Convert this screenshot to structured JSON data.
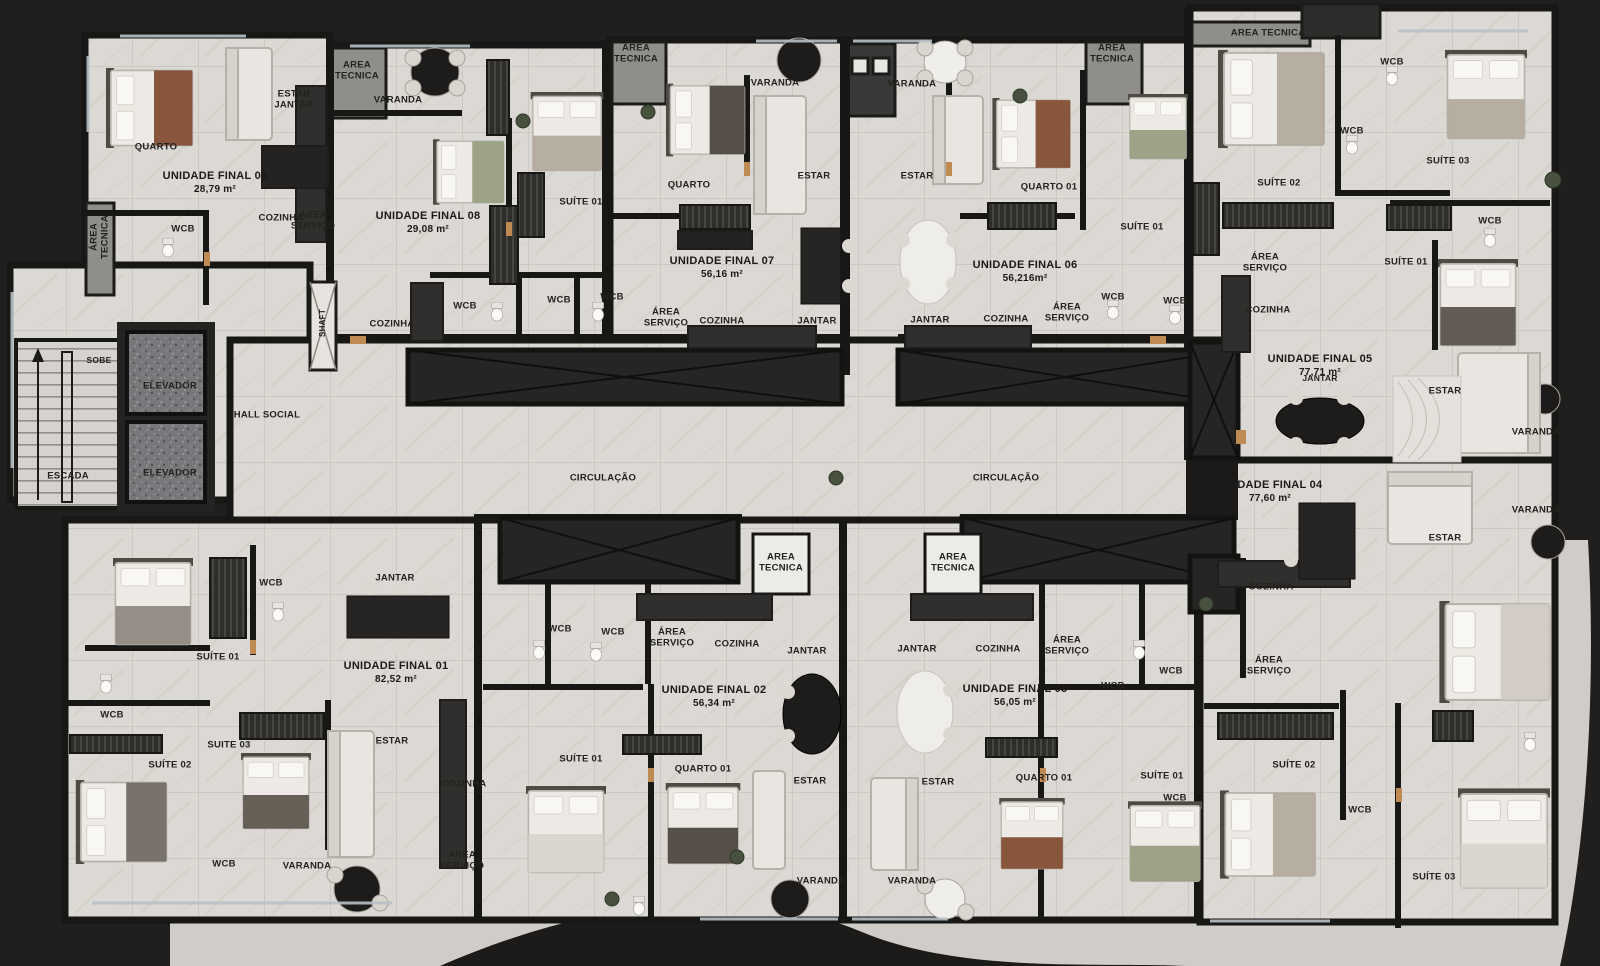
{
  "palette": {
    "background": "#201f1e",
    "floor": "#dcd9d4",
    "wall": "#171716",
    "tech_gray": "#8f8e8a",
    "white_box": "#edebe8",
    "wood_accent": "#c08b52",
    "label_color": "#23221f"
  },
  "units": [
    {
      "name": "UNIDADE FINAL 09",
      "area": "28,79 m²",
      "x": 215,
      "y": 183
    },
    {
      "name": "UNIDADE FINAL 08",
      "area": "29,08 m²",
      "x": 428,
      "y": 223
    },
    {
      "name": "UNIDADE FINAL 07",
      "area": "56,16 m²",
      "x": 722,
      "y": 268
    },
    {
      "name": "UNIDADE FINAL 06",
      "area": "56,216m²",
      "x": 1025,
      "y": 272
    },
    {
      "name": "UNIDADE FINAL 05",
      "area": "77,71 m²",
      "x": 1320,
      "y": 366
    },
    {
      "name": "UNIDADE FINAL 04",
      "area": "77,60 m²",
      "x": 1270,
      "y": 492
    },
    {
      "name": "UNIDADE FINAL 01",
      "area": "82,52 m²",
      "x": 396,
      "y": 673
    },
    {
      "name": "UNIDADE FINAL 02",
      "area": "56,34 m²",
      "x": 714,
      "y": 697
    },
    {
      "name": "UNIDADE FINAL 03",
      "area": "56,05 m²",
      "x": 1015,
      "y": 696
    }
  ],
  "rooms": [
    {
      "t": "QUARTO",
      "x": 156,
      "y": 147
    },
    {
      "t": "ESTAR\nJANTAR",
      "x": 294,
      "y": 100
    },
    {
      "t": "AREA\nTECNICA",
      "x": 357,
      "y": 71
    },
    {
      "t": "COZINHA",
      "x": 281,
      "y": 218
    },
    {
      "t": "ÁREA\nSERVIÇO",
      "x": 313,
      "y": 221
    },
    {
      "t": "WCB",
      "x": 183,
      "y": 229
    },
    {
      "t": "ÁREA\nTECNICA",
      "x": 100,
      "y": 237,
      "r": -90
    },
    {
      "t": "VARANDA",
      "x": 398,
      "y": 100
    },
    {
      "t": "SUÍTE 01",
      "x": 581,
      "y": 202
    },
    {
      "t": "WCB",
      "x": 465,
      "y": 306
    },
    {
      "t": "WCB",
      "x": 559,
      "y": 300
    },
    {
      "t": "COZINHA",
      "x": 392,
      "y": 324
    },
    {
      "t": "AREA\nTECNICA",
      "x": 636,
      "y": 54
    },
    {
      "t": "VARANDA",
      "x": 775,
      "y": 83
    },
    {
      "t": "QUARTO",
      "x": 689,
      "y": 185
    },
    {
      "t": "ESTAR",
      "x": 814,
      "y": 176
    },
    {
      "t": "WCB",
      "x": 612,
      "y": 297
    },
    {
      "t": "ÁREA\nSERVIÇO",
      "x": 666,
      "y": 318
    },
    {
      "t": "COZINHA",
      "x": 722,
      "y": 321
    },
    {
      "t": "JANTAR",
      "x": 817,
      "y": 321
    },
    {
      "t": "VARANDA",
      "x": 912,
      "y": 84
    },
    {
      "t": "AREA\nTECNICA",
      "x": 1112,
      "y": 54
    },
    {
      "t": "ESTAR",
      "x": 917,
      "y": 176
    },
    {
      "t": "QUARTO 01",
      "x": 1049,
      "y": 187
    },
    {
      "t": "SUÍTE 01",
      "x": 1142,
      "y": 227
    },
    {
      "t": "JANTAR",
      "x": 930,
      "y": 320
    },
    {
      "t": "COZINHA",
      "x": 1006,
      "y": 319
    },
    {
      "t": "ÁREA\nSERVIÇO",
      "x": 1067,
      "y": 313
    },
    {
      "t": "WCB",
      "x": 1113,
      "y": 297
    },
    {
      "t": "WCB",
      "x": 1175,
      "y": 301
    },
    {
      "t": "AREA TECNICA",
      "x": 1268,
      "y": 33
    },
    {
      "t": "WCB",
      "x": 1392,
      "y": 62
    },
    {
      "t": "WCB",
      "x": 1352,
      "y": 131
    },
    {
      "t": "SUÍTE 03",
      "x": 1448,
      "y": 161
    },
    {
      "t": "SUÍTE 02",
      "x": 1279,
      "y": 183
    },
    {
      "t": "WCB",
      "x": 1490,
      "y": 221
    },
    {
      "t": "SUÍTE 01",
      "x": 1406,
      "y": 262
    },
    {
      "t": "ÁREA\nSERVIÇO",
      "x": 1265,
      "y": 263
    },
    {
      "t": "COZINHA",
      "x": 1268,
      "y": 310
    },
    {
      "t": "JANTAR",
      "x": 1320,
      "y": 378,
      "s": 8.5
    },
    {
      "t": "ESTAR",
      "x": 1445,
      "y": 391
    },
    {
      "t": "VARANDA",
      "x": 1536,
      "y": 432
    },
    {
      "t": "SOBE",
      "x": 99,
      "y": 360,
      "s": 8.5
    },
    {
      "t": "ESCADA",
      "x": 68,
      "y": 476
    },
    {
      "t": "ELEVADOR",
      "x": 170,
      "y": 386
    },
    {
      "t": "ELEVADOR",
      "x": 170,
      "y": 473
    },
    {
      "t": "HALL SOCIAL",
      "x": 267,
      "y": 415
    },
    {
      "t": "SHAFT",
      "x": 323,
      "y": 323,
      "r": -90,
      "s": 8
    },
    {
      "t": "CIRCULAÇÃO",
      "x": 603,
      "y": 478
    },
    {
      "t": "CIRCULAÇÃO",
      "x": 1006,
      "y": 478
    },
    {
      "t": "AREA\nTECNICA",
      "x": 781,
      "y": 563
    },
    {
      "t": "AREA\nTECNICA",
      "x": 953,
      "y": 563
    },
    {
      "t": "VARANDA",
      "x": 1536,
      "y": 510
    },
    {
      "t": "ESTAR",
      "x": 1445,
      "y": 538
    },
    {
      "t": "COZINHA",
      "x": 1271,
      "y": 587
    },
    {
      "t": "ÁREA\nSERVIÇO",
      "x": 1269,
      "y": 666
    },
    {
      "t": "SUÍTE 02",
      "x": 1294,
      "y": 765
    },
    {
      "t": "WCB",
      "x": 1360,
      "y": 810
    },
    {
      "t": "SUÍTE 03",
      "x": 1434,
      "y": 877
    },
    {
      "t": "WCB",
      "x": 271,
      "y": 583
    },
    {
      "t": "JANTAR",
      "x": 395,
      "y": 578
    },
    {
      "t": "SUÍTE 01",
      "x": 218,
      "y": 657
    },
    {
      "t": "WCB",
      "x": 112,
      "y": 715
    },
    {
      "t": "SUITE 03",
      "x": 229,
      "y": 745
    },
    {
      "t": "SUÍTE 02",
      "x": 170,
      "y": 765
    },
    {
      "t": "ESTAR",
      "x": 392,
      "y": 741
    },
    {
      "t": "COZINHA",
      "x": 464,
      "y": 784
    },
    {
      "t": "ÁREA\nSERVIÇO",
      "x": 462,
      "y": 861
    },
    {
      "t": "WCB",
      "x": 224,
      "y": 864
    },
    {
      "t": "VARANDA",
      "x": 307,
      "y": 866
    },
    {
      "t": "WCB",
      "x": 560,
      "y": 629
    },
    {
      "t": "WCB",
      "x": 613,
      "y": 632
    },
    {
      "t": "ÁREA\nSERVIÇO",
      "x": 672,
      "y": 638
    },
    {
      "t": "COZINHA",
      "x": 737,
      "y": 644
    },
    {
      "t": "JANTAR",
      "x": 807,
      "y": 651
    },
    {
      "t": "SUÍTE 01",
      "x": 581,
      "y": 759
    },
    {
      "t": "QUARTO 01",
      "x": 703,
      "y": 769
    },
    {
      "t": "ESTAR",
      "x": 810,
      "y": 781
    },
    {
      "t": "VARANDA",
      "x": 821,
      "y": 881
    },
    {
      "t": "JANTAR",
      "x": 917,
      "y": 649
    },
    {
      "t": "COZINHA",
      "x": 998,
      "y": 649
    },
    {
      "t": "ÁREA\nSERVIÇO",
      "x": 1067,
      "y": 646
    },
    {
      "t": "WCB",
      "x": 1171,
      "y": 671
    },
    {
      "t": "WCB",
      "x": 1113,
      "y": 686
    },
    {
      "t": "QUARTO 01",
      "x": 1044,
      "y": 778
    },
    {
      "t": "SUÍTE 01",
      "x": 1162,
      "y": 776
    },
    {
      "t": "WCB",
      "x": 1175,
      "y": 798
    },
    {
      "t": "ESTAR",
      "x": 938,
      "y": 782
    },
    {
      "t": "VARANDA",
      "x": 912,
      "y": 881
    }
  ]
}
